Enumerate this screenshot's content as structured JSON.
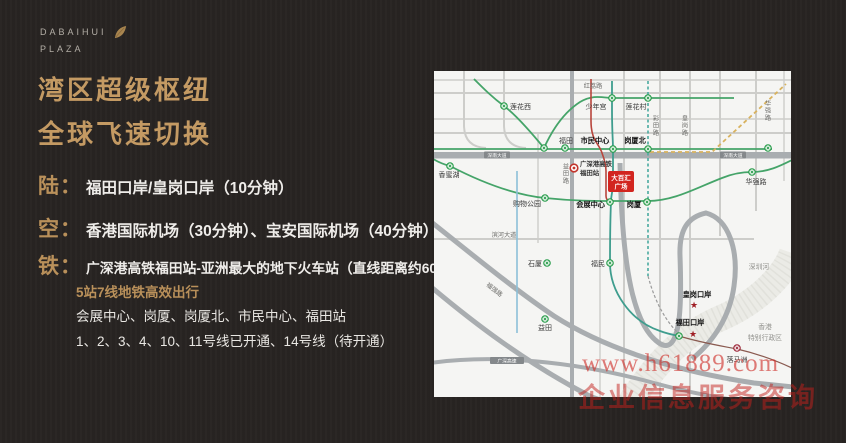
{
  "colors": {
    "gold": "#c49a63",
    "plaza_red": "#d2251f",
    "metro_green": "#259b48",
    "watermark_red": "#c32a25",
    "background": "#282422"
  },
  "logo": {
    "name": "DABAIHUI",
    "sub": "PLAZA"
  },
  "headline": {
    "line1": "湾区超级枢纽",
    "line2": "全球飞速切换"
  },
  "transport": {
    "land_label": "陆：",
    "land_text": "福田口岸/皇岗口岸（10分钟）",
    "air_label": "空：",
    "air_text": "香港国际机场（30分钟）、宝安国际机场（40分钟）",
    "rail_label": "铁：",
    "rail_text": "广深港高铁福田站-亚洲最大的地下火车站（直线距离约600米）",
    "rail_highlight": "5站7线地铁高效出行",
    "rail_stations": "会展中心、岗厦、岗厦北、市民中心、福田站",
    "rail_lines": "1、2、3、4、10、11号线已开通、14号线（待开通）"
  },
  "map": {
    "plaza_line1": "大百汇",
    "plaza_line2": "广场",
    "hsr_line1": "广深港高铁",
    "hsr_line2": "福田站",
    "roads": {
      "honglilu": "红荔路",
      "caitianlu": "彩田路",
      "huangganglu": "皇岗路",
      "huaqianglu_rd": "华强路",
      "shennan_w": "深南大道",
      "shennan_e": "深南大道",
      "yitianlu": "益田路",
      "binhe": "滨河大道",
      "fuqianglu": "福强路",
      "expressway": "广深高速"
    },
    "stations": {
      "lianhuaxi": "莲花西",
      "shaoniangong": "少年宫",
      "lianhuacun": "莲花村",
      "futian": "福田",
      "shiminzhongxin": "市民中心",
      "gangxiabei": "岗厦北",
      "xiangmihu": "香蜜湖",
      "gouwugongyuan": "购物公园",
      "huizhanzhongxin": "会展中心",
      "gangxia": "岗厦",
      "huaqianglu": "华强路",
      "shixia": "石厦",
      "fumin": "福民",
      "yitian": "益田"
    },
    "checkpoints": {
      "huanggangkouan": "皇岗口岸",
      "futiankouan": "福田口岸",
      "luomazhou": "落马洲"
    },
    "geo": {
      "shenzhenhe": "深圳河",
      "hk1": "香港",
      "hk2": "特别行政区"
    }
  },
  "watermark": {
    "url": "www.h61889.com",
    "caption": "企业信息服务咨询"
  }
}
